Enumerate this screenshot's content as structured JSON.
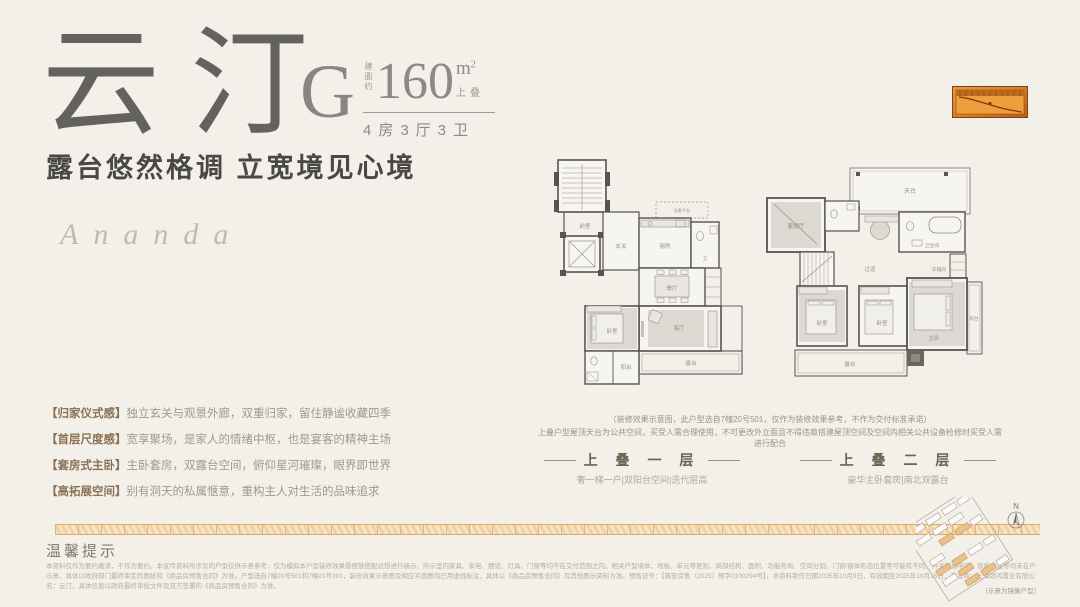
{
  "colors": {
    "bg": "#f3f0ea",
    "ink": "#63625e",
    "copper": "#c97a2e",
    "band": "#f6e4c6",
    "muted": "#a39889"
  },
  "header": {
    "title_char_1": "云",
    "title_char_2": "汀",
    "plan_letter": "G",
    "area_prefix": "建面约",
    "area_value": "160",
    "area_unit": "m",
    "area_sup": "2",
    "area_tag": "上叠",
    "rooms_label": "4房3厅3卫",
    "slogan": "露台悠然格调  立宽境见心境",
    "brand": "Ananda"
  },
  "features": [
    {
      "head": "【归家仪式感】",
      "body": "独立玄关与观景外廊，双重归家，留住静谧收藏四季"
    },
    {
      "head": "【首层尺度感】",
      "body": "宽享聚场，是家人的情绪中枢，也是宴客的精神主场"
    },
    {
      "head": "【套房式主卧】",
      "body": "主卧套房，双露台空间，俯仰星河璀璨，眼界即世界"
    },
    {
      "head": "【高拓展空间】",
      "body": "别有洞天的私属惬意，重构主人对生活的品味追求"
    }
  ],
  "plans": {
    "note_line1": "（装修效果示意图，此户型选自7幢20号501，仅作为装修效果参考，不作为交付标准承诺）",
    "note_line2": "上叠户型屋顶天台为公共空间，买受人需合理使用，不可更改外立面且不得违章搭建屋顶空间及空间内相关公共设备检修时买受人需进行配合",
    "floor1": {
      "label": "上 叠 一 层",
      "caption": "奢一梯一户|双阳台空间|迭代层高",
      "rooms": {
        "foyer": "前室",
        "entry": "玄关",
        "kitchen": "厨房",
        "equip": "设备平台",
        "bath": "卫",
        "dining": "餐厅",
        "living": "客厅",
        "bedroom": "卧室",
        "balcony": "阳台",
        "terrace": "露台"
      }
    },
    "floor2": {
      "label": "上 叠 二 层",
      "caption": "豪华主卧套房|南北双露台",
      "rooms": {
        "roof": "天台",
        "family": "家庭厅",
        "bath": "卫生间",
        "cloak": "衣帽间",
        "hall": "过道",
        "bed1": "卧室",
        "bed2": "卧室",
        "master": "主卧",
        "balcony": "阳台",
        "terrace": "露台"
      }
    }
  },
  "footer": {
    "notice_title": "温馨提示",
    "disclaimer_line1": "本资料仅作为要约邀请，不作为要约。本宣传资料所涉及的户型仅供示意参考，仅为模拟本户型装修效果暨摆放搭配设想进行展示，所示室内家具、家电、摆设、灯具、门窗等均不在交付范围之内，相关户型墙体、地板、单元等差别，局部结构、面积、功能布局、空间分割、门窗/窗体形态位置等可能有不同，开关强弱电箱、隐蔽位置等均未在户型图中",
    "disclaimer_line2": "示意，具体以政府部门最终审定的图纸和《商品房预售合同》为准。户型选自7幢20号501和7幢21号301，装修效果示意图及相应平面图均已用虚线标注，具体以《商品房预售合同》及其他图示资料为准。预售证号：【慈安房售（2025）预字0100294号】，本资料制作日期2025年10月9日，有效期至2025年10月15日，开发商：上海颂鸿置业有限公司，推广",
    "disclaimer_line3": "名：云汀。具体信息以政府最终审批文件及双方签署的《商品房预售合同》为准。",
    "siteplan_caption": "（示意为镜像户型）",
    "compass_label": "N"
  }
}
